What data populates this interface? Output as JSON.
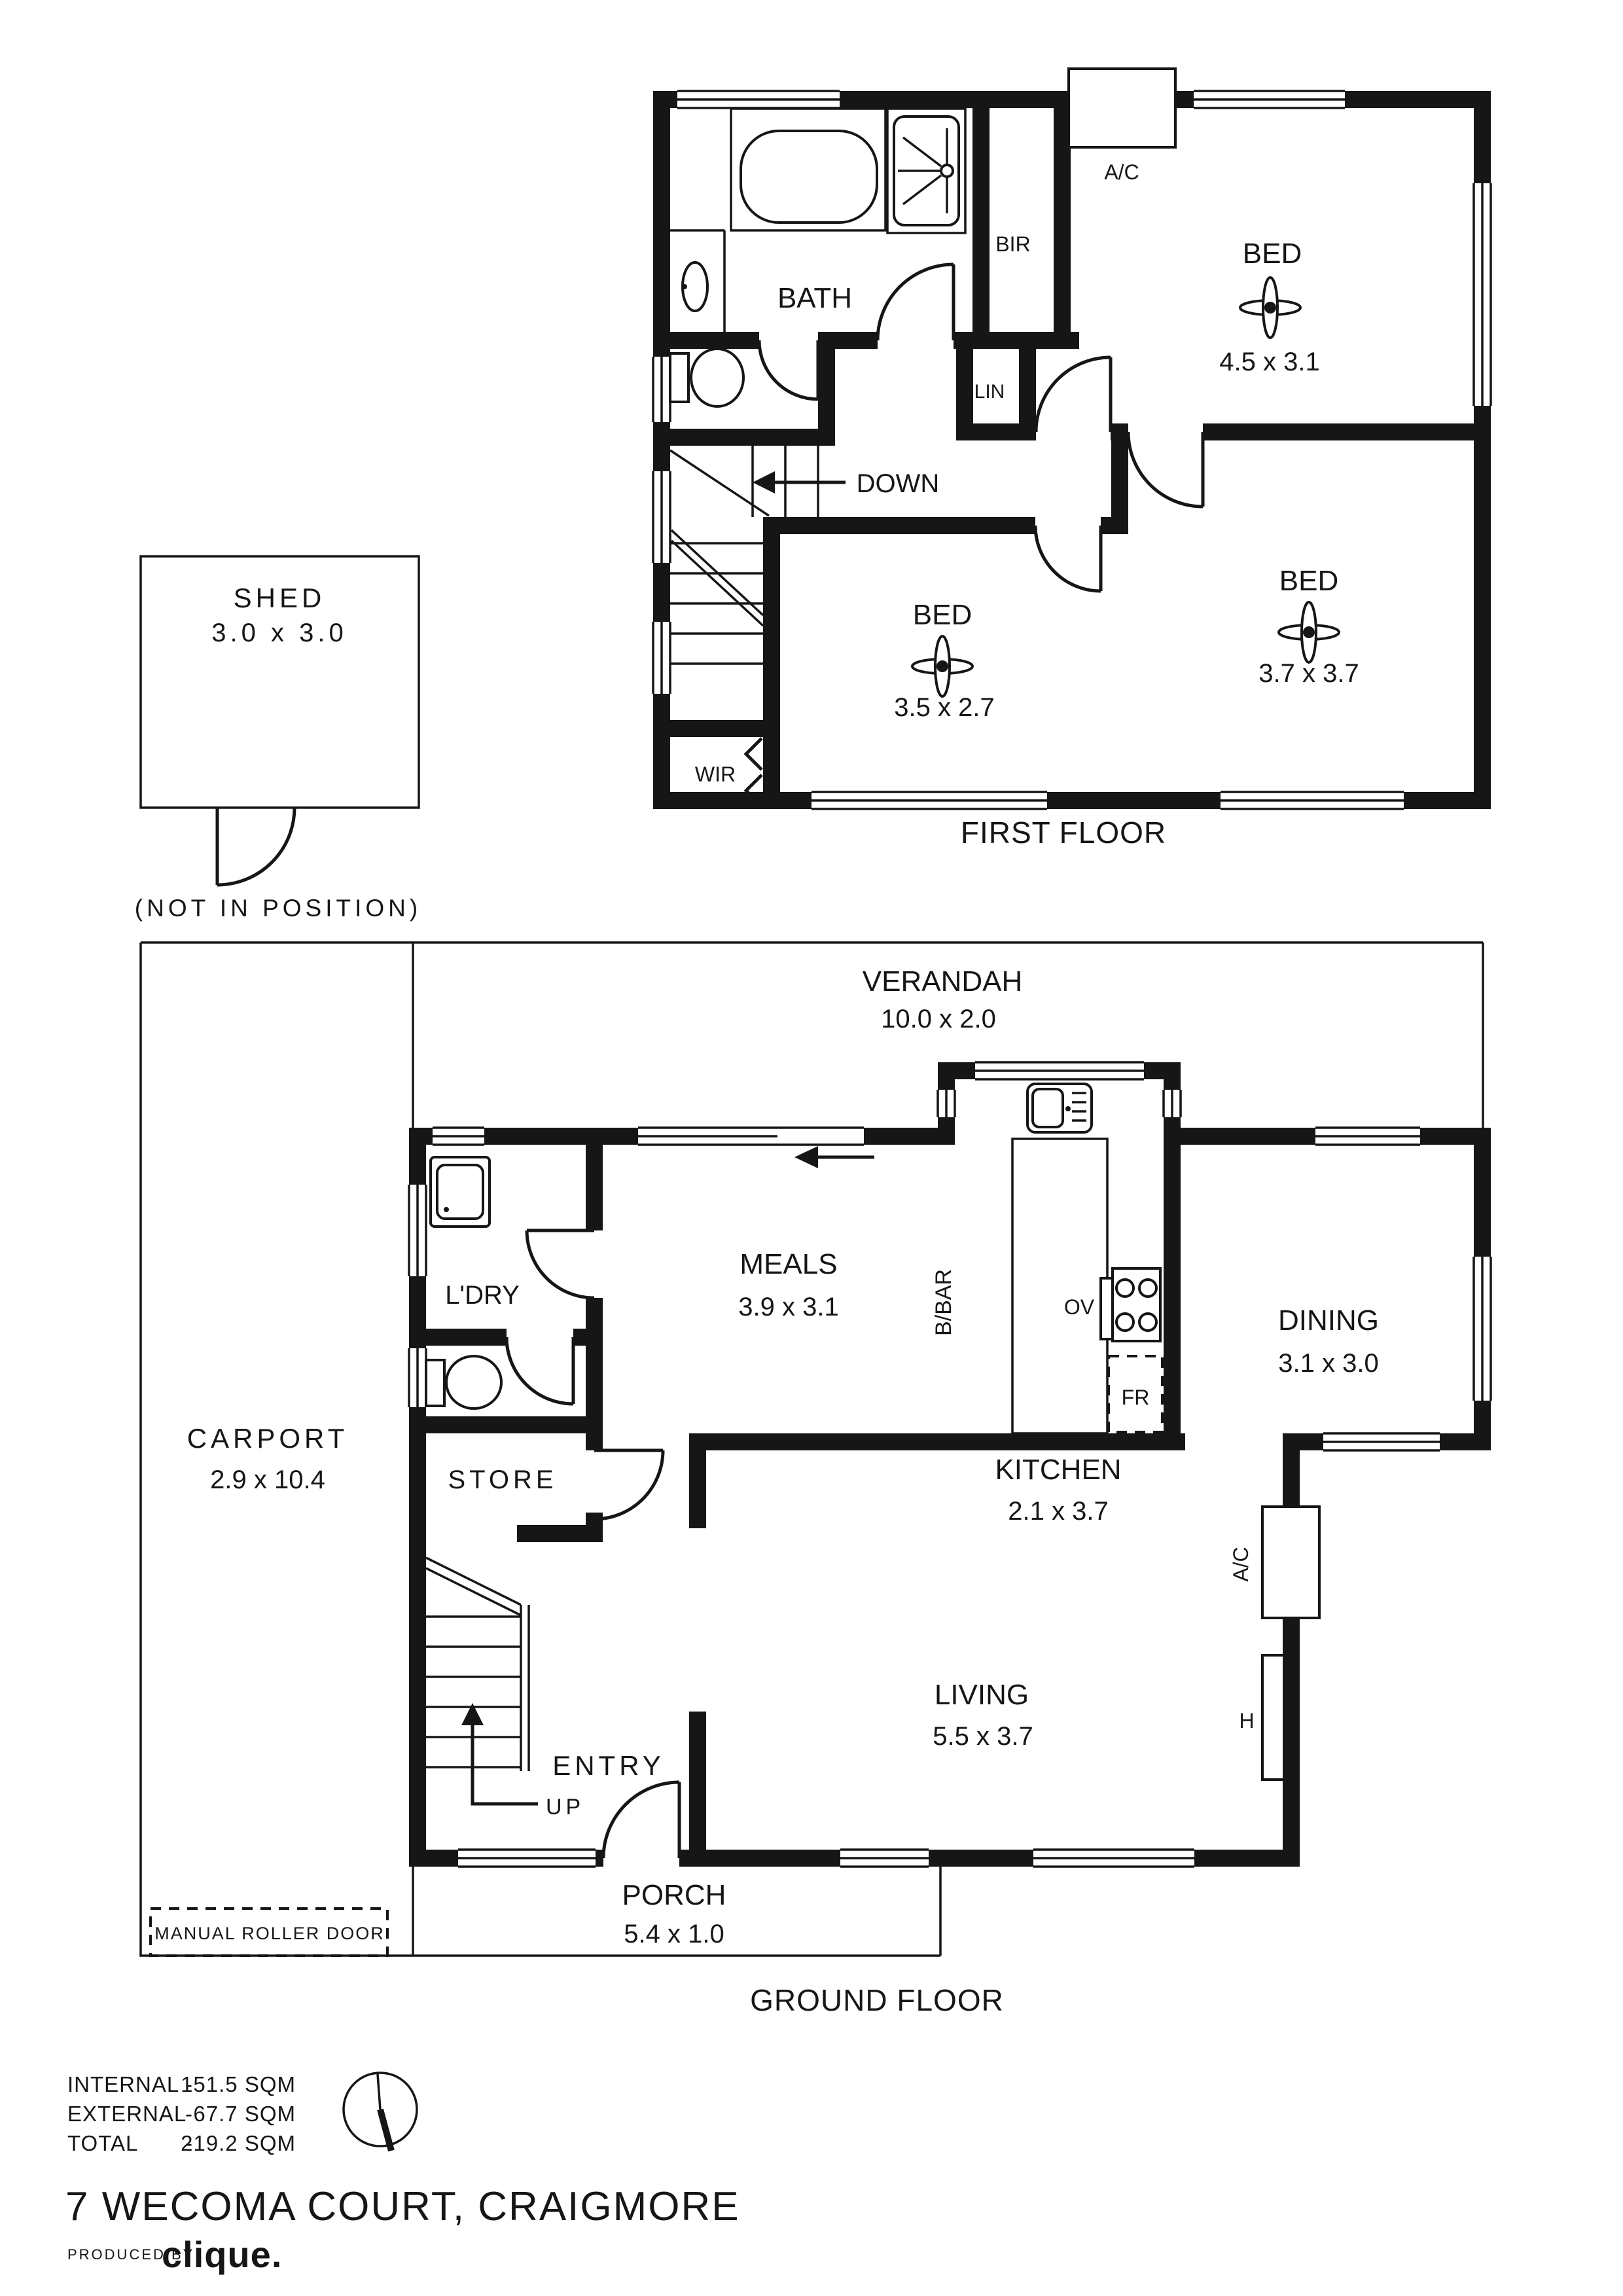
{
  "title": "7 WECOMA COURT, CRAIGMORE",
  "footer": {
    "produced_by": "PRODUCED BY",
    "brand": "clique."
  },
  "legend": {
    "rows": [
      {
        "label": "INTERNAL",
        "dash": "-",
        "value": "151.5 SQM"
      },
      {
        "label": "EXTERNAL",
        "dash": "-",
        "value": "67.7 SQM"
      },
      {
        "label": "TOTAL",
        "dash": "-",
        "value": "219.2 SQM"
      }
    ]
  },
  "shed": {
    "label": "SHED",
    "dims": "3.0 x 3.0",
    "note": "(NOT IN POSITION)"
  },
  "ff": {
    "floor_label": "FIRST FLOOR",
    "bath": "BATH",
    "bir": "BIR",
    "lin": "LIN",
    "ac": "A/C",
    "down": "DOWN",
    "wir": "WIR",
    "bed1": "BED",
    "bed1_dims": "4.5 x 3.1",
    "bed2": "BED",
    "bed2_dims": "3.5 x 2.7",
    "bed3": "BED",
    "bed3_dims": "3.7 x 3.7"
  },
  "gf": {
    "floor_label": "GROUND FLOOR",
    "verandah": "VERANDAH",
    "verandah_dims": "10.0 x 2.0",
    "carport": "CARPORT",
    "carport_dims": "2.9 x 10.4",
    "ldry": "L'DRY",
    "meals": "MEALS",
    "meals_dims": "3.9 x 3.1",
    "bbar": "B/BAR",
    "ov": "OV",
    "fr": "FR",
    "kitchen": "KITCHEN",
    "kitchen_dims": "2.1 x 3.7",
    "dining": "DINING",
    "dining_dims": "3.1 x 3.0",
    "store": "STORE",
    "living": "LIVING",
    "living_dims": "5.5 x 3.7",
    "ac": "A/C",
    "h": "H",
    "entry": "ENTRY",
    "up": "UP",
    "porch": "PORCH",
    "porch_dims": "5.4 x 1.0",
    "roller": "MANUAL ROLLER DOOR"
  }
}
